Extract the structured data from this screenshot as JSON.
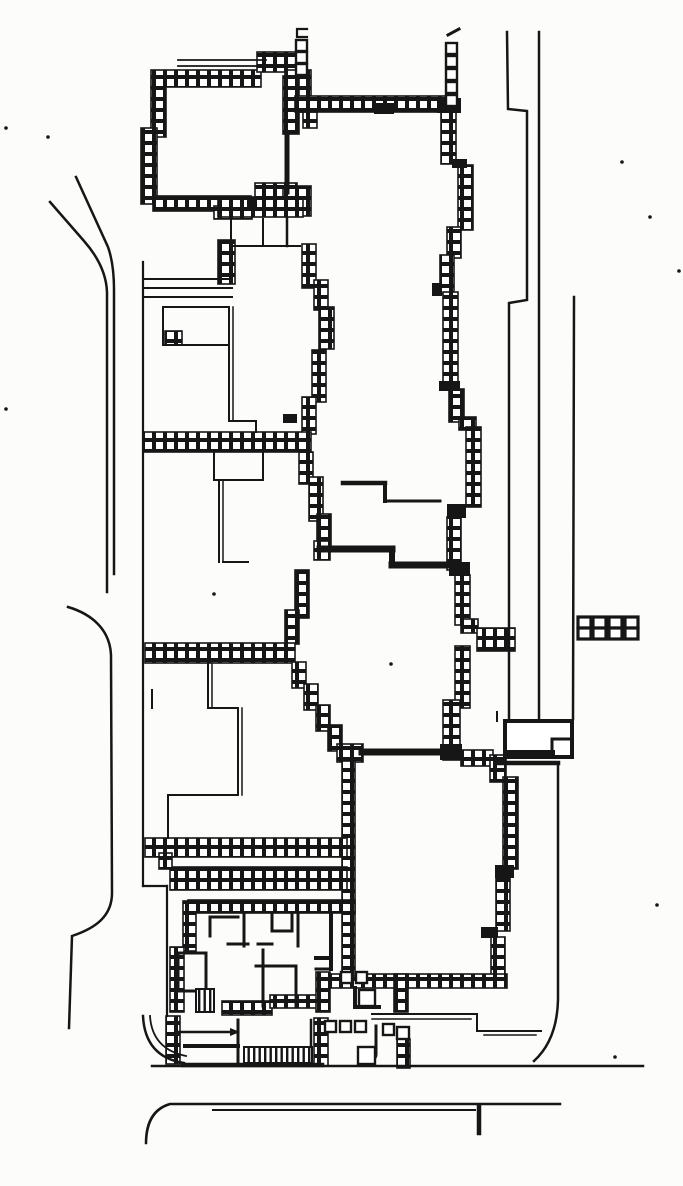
{
  "canvas": {
    "w": 683,
    "h": 1186,
    "bg": "#fcfcfa",
    "ink": "#161616"
  },
  "plan": {
    "description": "scanned-architectural-site-plan",
    "hatch_walls": [
      [
        151,
        70,
        110,
        17
      ],
      [
        257,
        52,
        42,
        20
      ],
      [
        285,
        70,
        26,
        42
      ],
      [
        151,
        87,
        15,
        50
      ],
      [
        141,
        128,
        16,
        76
      ],
      [
        153,
        196,
        98,
        15
      ],
      [
        214,
        206,
        38,
        13
      ],
      [
        283,
        76,
        16,
        58
      ],
      [
        255,
        183,
        42,
        16
      ],
      [
        283,
        186,
        28,
        30
      ],
      [
        303,
        112,
        14,
        16
      ],
      [
        218,
        197,
        85,
        20
      ],
      [
        295,
        96,
        162,
        16
      ],
      [
        441,
        112,
        15,
        52
      ],
      [
        458,
        165,
        15,
        65
      ],
      [
        447,
        227,
        14,
        31
      ],
      [
        440,
        255,
        14,
        39
      ],
      [
        443,
        292,
        15,
        92
      ],
      [
        449,
        389,
        15,
        33
      ],
      [
        459,
        417,
        17,
        13
      ],
      [
        466,
        427,
        15,
        80
      ],
      [
        447,
        517,
        14,
        53
      ],
      [
        455,
        575,
        15,
        50
      ],
      [
        461,
        619,
        17,
        14
      ],
      [
        477,
        628,
        38,
        23
      ],
      [
        455,
        646,
        15,
        62
      ],
      [
        443,
        700,
        17,
        60
      ],
      [
        218,
        240,
        17,
        44
      ],
      [
        302,
        244,
        14,
        44
      ],
      [
        314,
        280,
        14,
        30
      ],
      [
        319,
        307,
        15,
        42
      ],
      [
        312,
        350,
        14,
        52
      ],
      [
        302,
        397,
        14,
        37
      ],
      [
        143,
        432,
        168,
        20
      ],
      [
        165,
        331,
        17,
        14
      ],
      [
        299,
        452,
        14,
        32
      ],
      [
        309,
        477,
        14,
        44
      ],
      [
        317,
        514,
        14,
        33
      ],
      [
        314,
        541,
        16,
        19
      ],
      [
        295,
        570,
        14,
        48
      ],
      [
        285,
        610,
        14,
        34
      ],
      [
        145,
        643,
        150,
        20
      ],
      [
        292,
        662,
        14,
        26
      ],
      [
        304,
        684,
        14,
        26
      ],
      [
        316,
        705,
        14,
        26
      ],
      [
        328,
        725,
        14,
        26
      ],
      [
        337,
        744,
        26,
        18
      ],
      [
        461,
        750,
        32,
        16
      ],
      [
        490,
        755,
        16,
        27
      ],
      [
        503,
        777,
        15,
        92
      ],
      [
        496,
        876,
        14,
        55
      ],
      [
        491,
        937,
        14,
        42
      ],
      [
        330,
        974,
        177,
        14
      ],
      [
        342,
        761,
        13,
        215
      ],
      [
        145,
        838,
        202,
        19
      ],
      [
        170,
        867,
        177,
        23
      ],
      [
        159,
        853,
        13,
        16
      ],
      [
        183,
        901,
        13,
        50
      ],
      [
        170,
        947,
        14,
        65
      ],
      [
        188,
        900,
        167,
        13
      ],
      [
        166,
        1016,
        14,
        48
      ],
      [
        222,
        1001,
        50,
        14
      ],
      [
        270,
        995,
        48,
        13
      ],
      [
        316,
        972,
        14,
        40
      ],
      [
        394,
        974,
        14,
        38
      ],
      [
        314,
        1018,
        14,
        48
      ],
      [
        397,
        1039,
        13,
        29
      ]
    ],
    "black_rects": [
      [
        437,
        98,
        24,
        15
      ],
      [
        452,
        159,
        15,
        9
      ],
      [
        432,
        283,
        10,
        13
      ],
      [
        439,
        381,
        21,
        10
      ],
      [
        447,
        504,
        19,
        14
      ],
      [
        449,
        562,
        21,
        14
      ],
      [
        440,
        744,
        22,
        16
      ],
      [
        495,
        865,
        19,
        13
      ],
      [
        481,
        927,
        17,
        11
      ],
      [
        283,
        414,
        14,
        9
      ],
      [
        247,
        197,
        10,
        14
      ],
      [
        374,
        103,
        20,
        11
      ]
    ],
    "strokes": [
      {
        "d": "M50,202 L84,241 Q106,266 107,292 L107,592",
        "w": 2.5
      },
      {
        "d": "M76,177 L108,247 Q114,264 114,290 L114,574",
        "w": 2.5
      },
      {
        "d": "M68,607 C92,614 110,630 111,655 L112,893 C112,916 96,928 72,936 L69,1028",
        "w": 2.5
      },
      {
        "d": "M507,32 L508,109 L527,111 L527,300 L509,303 L509,719",
        "w": 2.5
      },
      {
        "d": "M539,32 L539,719",
        "w": 2.5
      },
      {
        "d": "M574,297 L573,719",
        "w": 2.5
      },
      {
        "d": "M558,764 L558,1000 Q557,1040 534,1061",
        "w": 2.5
      },
      {
        "d": "M505,721 H572 V757 H505 Z",
        "w": 4,
        "f": 1
      },
      {
        "d": "M552,739 H572",
        "w": 3
      },
      {
        "d": "M552,739 V757",
        "w": 3
      },
      {
        "d": "M508,753 H552",
        "w": 6
      },
      {
        "d": "M497,763 H558",
        "w": 4.5
      },
      {
        "d": "M497,712 V721",
        "w": 2
      },
      {
        "d": "M152,1066 H643",
        "w": 2.5
      },
      {
        "d": "M146,1143 Q146,1111 170,1104 L560,1104",
        "w": 2.5
      },
      {
        "d": "M213,1110 H475",
        "w": 2
      },
      {
        "d": "M479,1106 V1133",
        "w": 4.5
      },
      {
        "d": "M372,1014 H477",
        "w": 2
      },
      {
        "d": "M477,1014 V1031",
        "w": 2
      },
      {
        "d": "M477,1031 H541",
        "w": 2
      },
      {
        "d": "M372,1019 H471",
        "w": 1.5
      },
      {
        "d": "M484,1035 H536",
        "w": 1.5
      },
      {
        "d": "M143,1016 Q145,1057 184,1063",
        "w": 2.5
      },
      {
        "d": "M150,1016 Q152,1049 186,1056",
        "w": 1.8
      },
      {
        "d": "M143,262 V886",
        "w": 2.2
      },
      {
        "d": "M143,886 H167",
        "w": 2.2
      },
      {
        "d": "M167,886 V1016",
        "w": 2.2
      },
      {
        "d": "M178,60 H266",
        "w": 1.8
      },
      {
        "d": "M178,66 H266",
        "w": 1.8
      },
      {
        "d": "M287,133 V192",
        "w": 5
      },
      {
        "d": "M231,219 V246",
        "w": 2
      },
      {
        "d": "M263,219 V246",
        "w": 2
      },
      {
        "d": "M231,246 H300",
        "w": 2
      },
      {
        "d": "M287,218 V246",
        "w": 2.5
      },
      {
        "d": "M144,279 H232",
        "w": 2
      },
      {
        "d": "M144,288 H232",
        "w": 2
      },
      {
        "d": "M144,297 H232",
        "w": 2
      },
      {
        "d": "M163,307 H228",
        "w": 2
      },
      {
        "d": "M163,307 V345",
        "w": 2
      },
      {
        "d": "M163,345 H228",
        "w": 2
      },
      {
        "d": "M229,307 V421",
        "w": 2
      },
      {
        "d": "M233,307 V421",
        "w": 1.5
      },
      {
        "d": "M229,421 H256",
        "w": 2
      },
      {
        "d": "M256,421 V432",
        "w": 2
      },
      {
        "d": "M214,452 V480",
        "w": 2
      },
      {
        "d": "M214,480 H263",
        "w": 2
      },
      {
        "d": "M263,452 V480",
        "w": 2
      },
      {
        "d": "M219,480 V562",
        "w": 2
      },
      {
        "d": "M223,480 V562",
        "w": 1.5
      },
      {
        "d": "M223,562 H248",
        "w": 2
      },
      {
        "d": "M152,690 V708",
        "w": 2
      },
      {
        "d": "M208,663 V708",
        "w": 2
      },
      {
        "d": "M212,663 V708",
        "w": 1.5
      },
      {
        "d": "M208,708 H238",
        "w": 2
      },
      {
        "d": "M238,708 V795",
        "w": 2
      },
      {
        "d": "M242,708 V795",
        "w": 1.5
      },
      {
        "d": "M168,795 H238",
        "w": 2
      },
      {
        "d": "M168,797 V838",
        "w": 2
      },
      {
        "d": "M343,483 H385",
        "w": 4.5
      },
      {
        "d": "M385,483 V501",
        "w": 4
      },
      {
        "d": "M385,501 H440",
        "w": 3
      },
      {
        "d": "M320,549 H392",
        "w": 7
      },
      {
        "d": "M392,549 V565",
        "w": 6
      },
      {
        "d": "M392,565 H450",
        "w": 7
      },
      {
        "d": "M362,752 H446",
        "w": 7
      },
      {
        "d": "M210,917 H238",
        "w": 3
      },
      {
        "d": "M210,917 V936",
        "w": 3
      },
      {
        "d": "M244,913 V946",
        "w": 3
      },
      {
        "d": "M228,944 H248",
        "w": 3
      },
      {
        "d": "M258,944 H272",
        "w": 3
      },
      {
        "d": "M272,913 V931",
        "w": 3
      },
      {
        "d": "M272,931 H292",
        "w": 3
      },
      {
        "d": "M292,913 V931",
        "w": 3
      },
      {
        "d": "M298,913 V946",
        "w": 3
      },
      {
        "d": "M178,953 H206",
        "w": 3
      },
      {
        "d": "M206,953 V991",
        "w": 3
      },
      {
        "d": "M178,991 H206",
        "w": 3
      },
      {
        "d": "M178,953 V991",
        "w": 3
      },
      {
        "d": "M263,950 V1006",
        "w": 3
      },
      {
        "d": "M256,966 H296",
        "w": 3
      },
      {
        "d": "M296,966 V1006",
        "w": 3
      },
      {
        "d": "M316,958 H331",
        "w": 4
      },
      {
        "d": "M331,913 V969",
        "w": 4
      },
      {
        "d": "M316,969 H331",
        "w": 3
      },
      {
        "d": "M238,1020 V1062",
        "w": 3
      },
      {
        "d": "M311,1020 V1048",
        "w": 2.5
      },
      {
        "d": "M183,1065 H322",
        "w": 4.5
      },
      {
        "d": "M178,1032 H230",
        "w": 2.5
      },
      {
        "d": "M185,1046 H238",
        "w": 4
      },
      {
        "d": "M355,988 V1007 H379",
        "w": 4
      },
      {
        "d": "M376,1026 V1054 Q376,1061 366,1061",
        "w": 3
      },
      {
        "d": "M307,29 H297 V37 H307",
        "w": 2.2
      },
      {
        "d": "M448,35 L459,29",
        "w": 3
      }
    ],
    "polys": [
      [
        [
          230,
          1028
        ],
        [
          240,
          1032
        ],
        [
          230,
          1036
        ]
      ]
    ],
    "open_squares": [
      [
        296,
        40,
        11
      ],
      [
        296,
        52,
        11
      ],
      [
        296,
        64,
        11
      ],
      [
        446,
        43,
        11
      ],
      [
        446,
        56,
        11
      ],
      [
        446,
        69,
        11
      ],
      [
        446,
        82,
        11
      ],
      [
        446,
        95,
        11
      ],
      [
        341,
        972,
        11
      ],
      [
        356,
        972,
        11
      ],
      [
        359,
        990,
        16
      ],
      [
        325,
        1021,
        11
      ],
      [
        340,
        1021,
        11
      ],
      [
        355,
        1021,
        11
      ],
      [
        383,
        1024,
        11
      ],
      [
        397,
        1027,
        12
      ],
      [
        358,
        1047,
        17
      ]
    ],
    "pier_blocks": [
      [
        578,
        617
      ],
      [
        593,
        617
      ],
      [
        609,
        617
      ],
      [
        625,
        617
      ]
    ],
    "stair_rects": [
      [
        196,
        989,
        18,
        23
      ],
      [
        244,
        1047,
        68,
        16
      ]
    ],
    "specks": [
      [
        48,
        137
      ],
      [
        6,
        128
      ],
      [
        6,
        409
      ],
      [
        622,
        162
      ],
      [
        650,
        217
      ],
      [
        679,
        271
      ],
      [
        657,
        905
      ],
      [
        615,
        1057
      ],
      [
        391,
        664
      ],
      [
        214,
        594
      ]
    ]
  }
}
